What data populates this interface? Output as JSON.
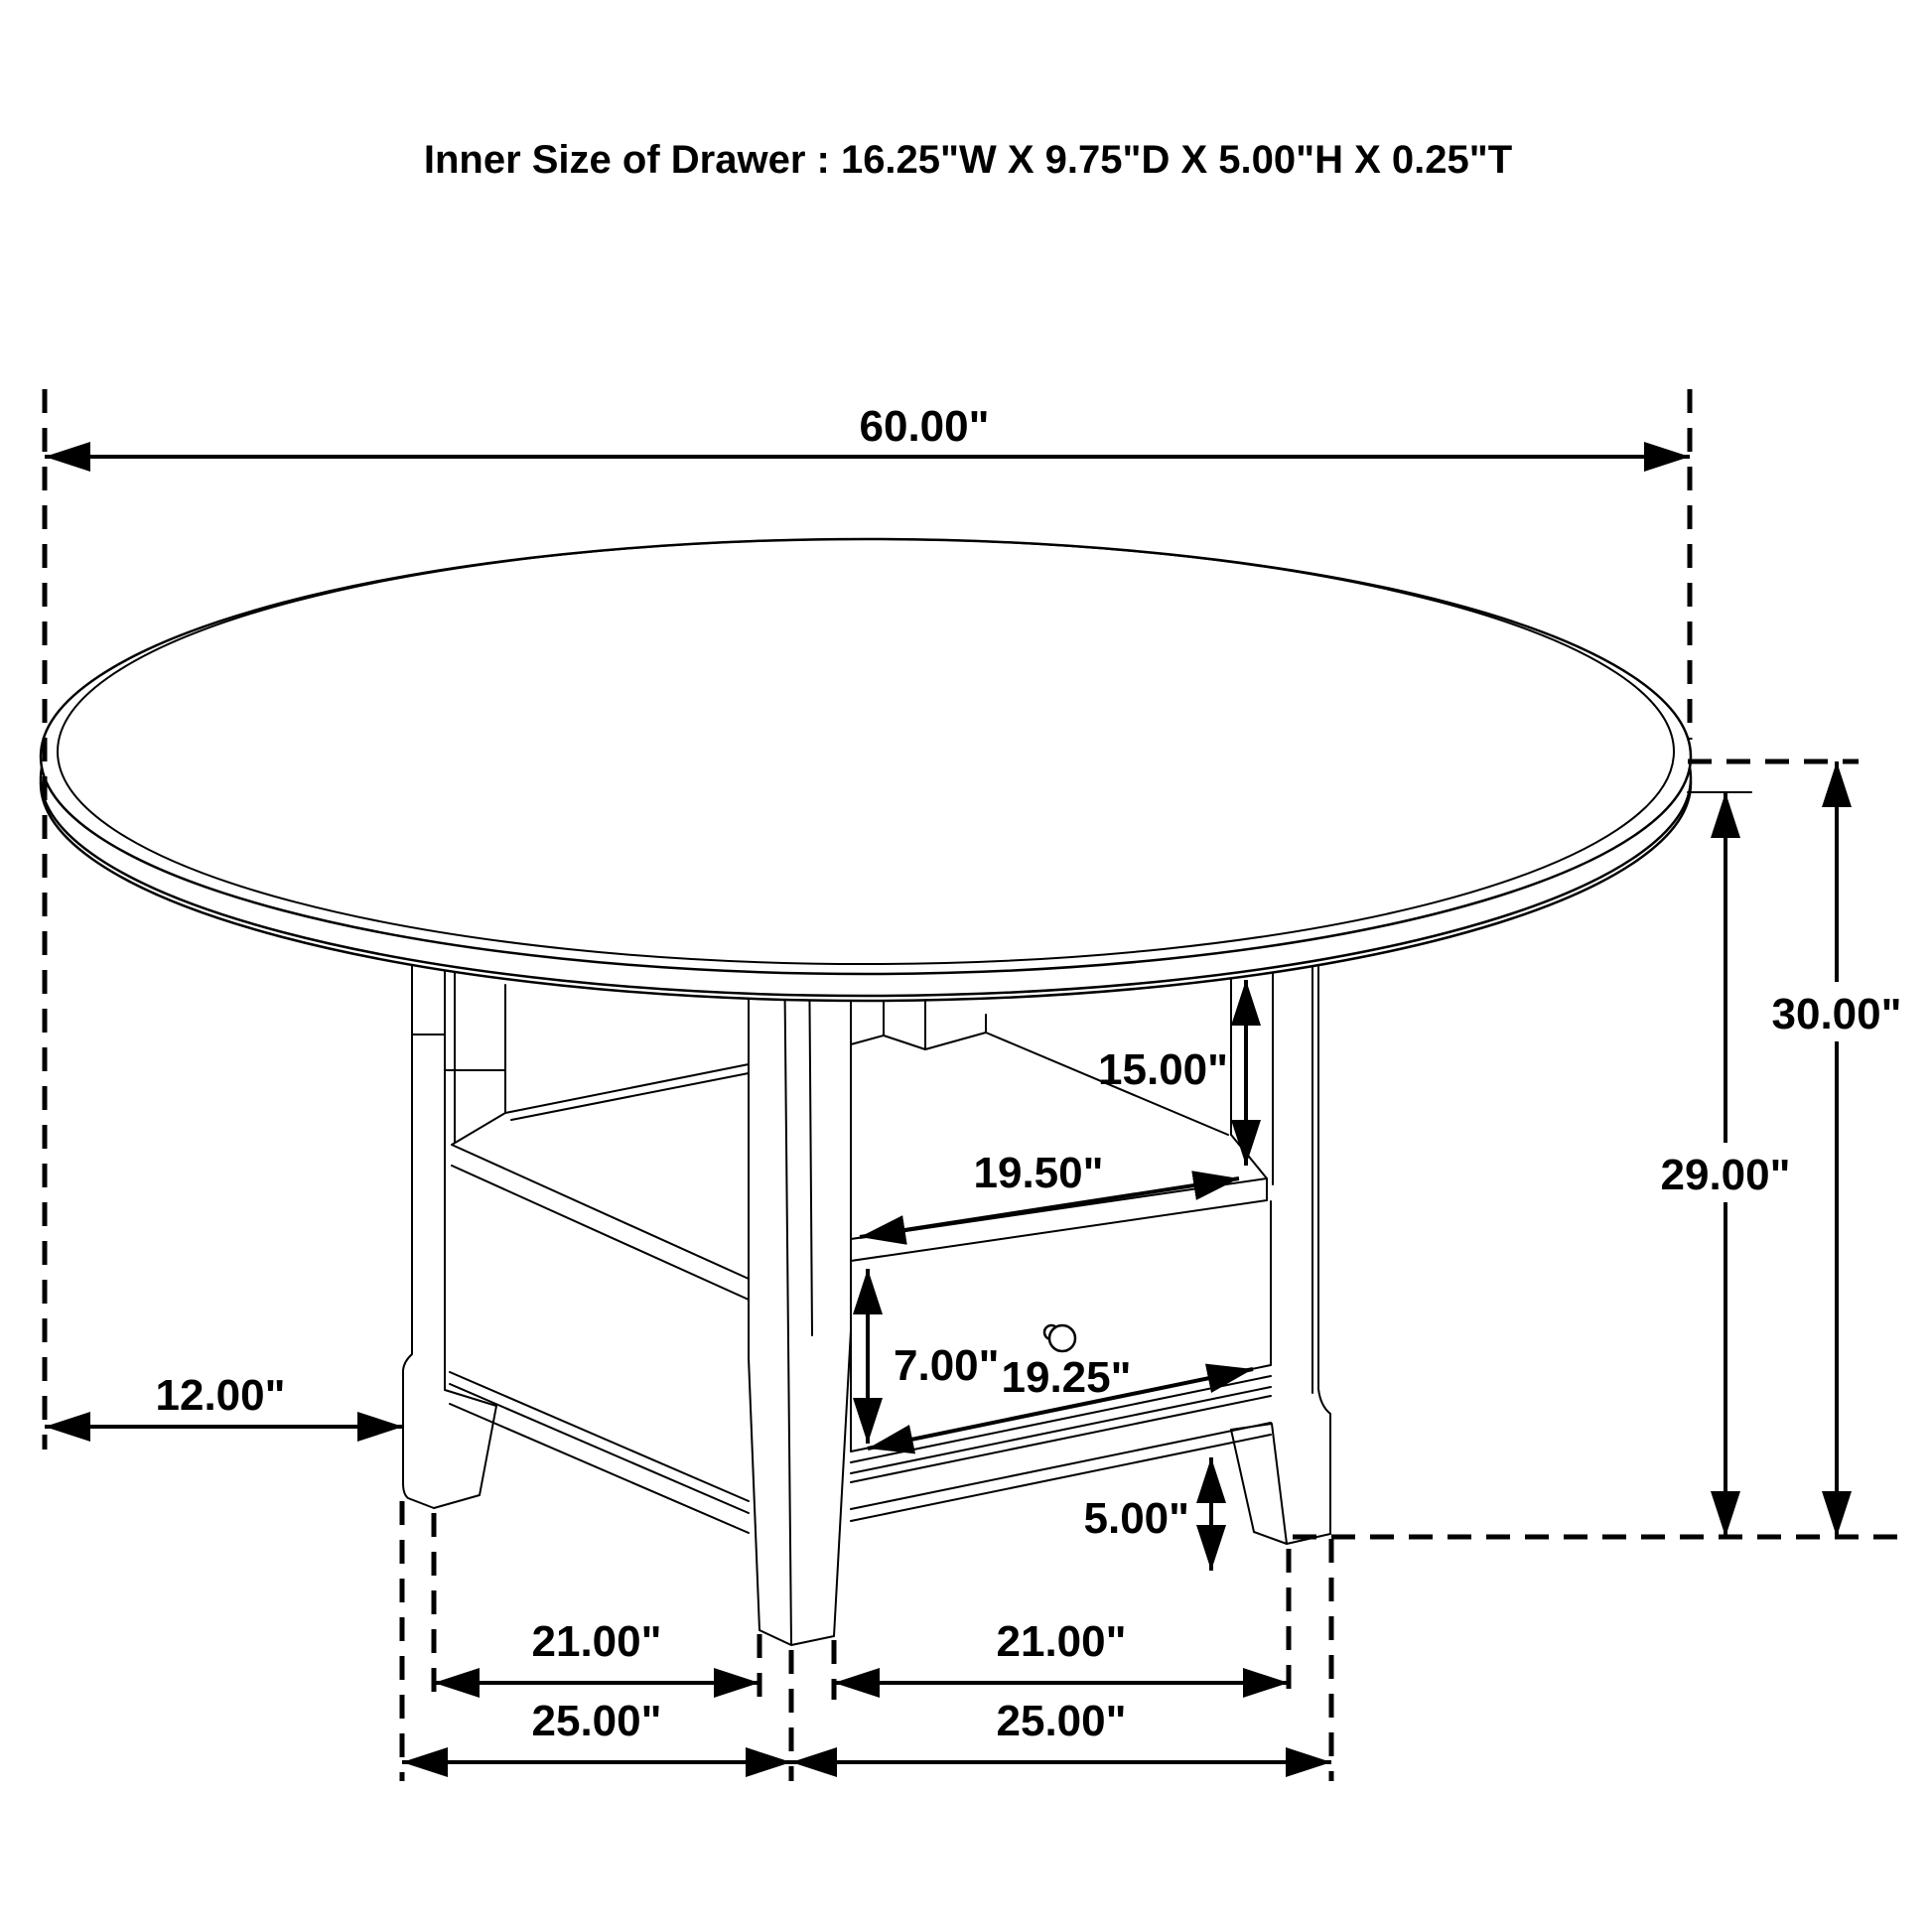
{
  "title": "Inner Size of Drawer : 16.25\"W X 9.75\"D X 5.00\"H X 0.25\"T",
  "dimensions": {
    "table_diameter": "60.00\"",
    "table_height_total": "30.00\"",
    "table_height_underside": "29.00\"",
    "compartment_opening_height": "15.00\"",
    "shelf_width": "19.50\"",
    "drawer_face_height": "7.00\"",
    "drawer_face_width": "19.25\"",
    "floor_clearance": "5.00\"",
    "top_overhang": "12.00\"",
    "leg_inner_span_left": "21.00\"",
    "leg_inner_span_right": "21.00\"",
    "leg_outer_span_left": "25.00\"",
    "leg_outer_span_right": "25.00\""
  },
  "colors": {
    "line": "#000000",
    "background": "#ffffff"
  }
}
